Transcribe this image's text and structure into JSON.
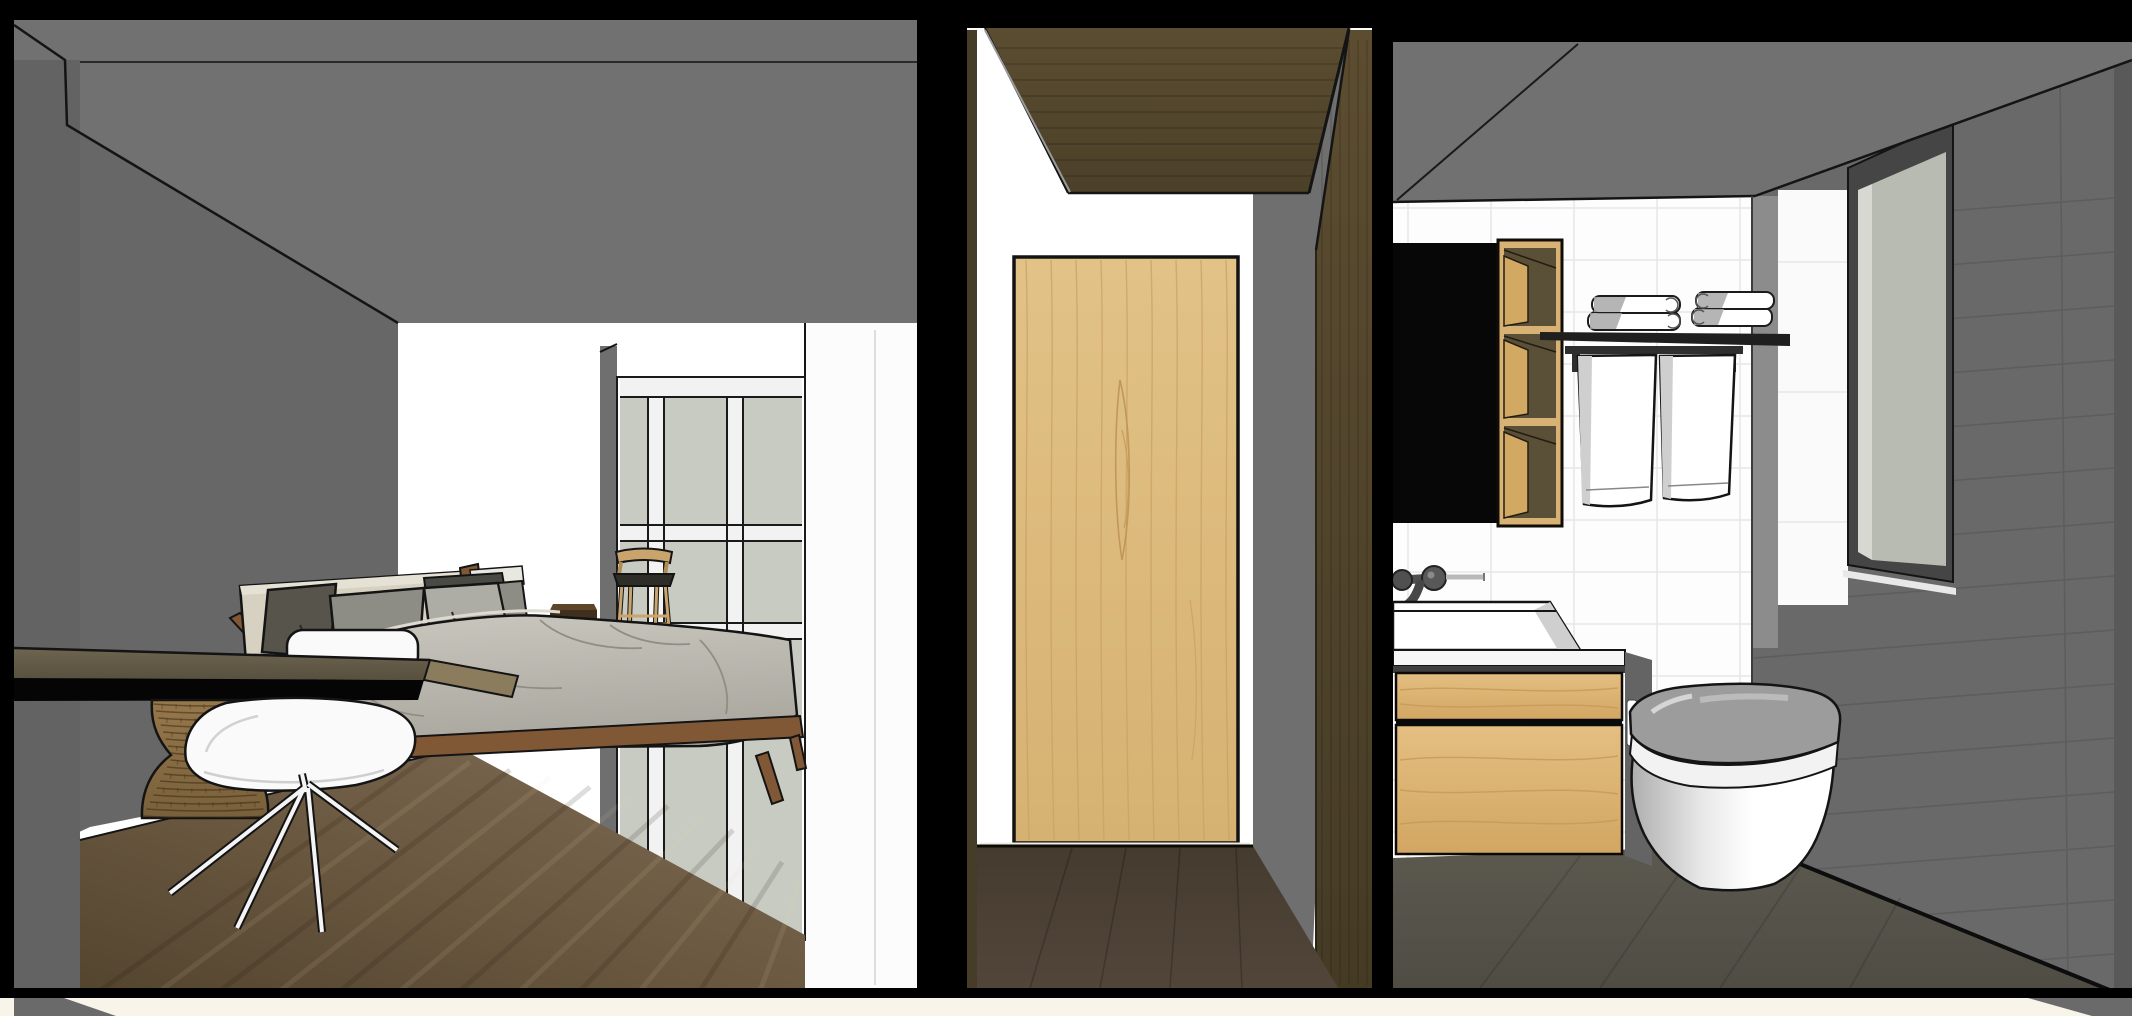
{
  "scene": {
    "title": "apartment-section-render",
    "view": "cutaway perspective section of bedroom, hallway and bathroom",
    "rooms": {
      "bedroom": {
        "label": "bedroom",
        "contents": [
          "bed",
          "pillows",
          "duvet",
          "headboard",
          "desk",
          "white-swivel-chair",
          "wicker-stool",
          "bar-stool",
          "nightstand",
          "glazed-wardrobe-wall",
          "wood-floor"
        ]
      },
      "hallway": {
        "label": "hallway",
        "contents": [
          "oak-door",
          "wood-ceiling",
          "wood-floor"
        ]
      },
      "bathroom": {
        "label": "bathroom",
        "contents": [
          "black-cabinet",
          "oak-shelf-unit",
          "towel-shelf",
          "folded-towels",
          "hanging-towels",
          "wall-faucet",
          "vessel-sink",
          "oak-vanity",
          "toilet",
          "window",
          "tiled-wall"
        ]
      }
    },
    "colors": {
      "frame": "#000000",
      "bottom_strip": "#f8f4ea",
      "ceiling_gray": "#717171",
      "wall_gray": "#6f6f6f",
      "wall_gray_dark": "#676767",
      "wall_cut_gray": "#636363",
      "white_wall": "#ffffff",
      "white_strip": "#fcfcfc",
      "glass_green": "#c8cbc2",
      "mullion": "#f2f2f2",
      "window_glass": "#b8bbb1",
      "window_frame": "#454545",
      "sash_light": "#d8d8d3",
      "hall_ceiling": "#55492e",
      "hall_column": "#54472c",
      "hall_sliver": "#473c27",
      "door_oak": "#dcbb80",
      "hall_floor": "#4b4033",
      "tile_white": "#fdfdfd",
      "tile_grout": "#e7e7e7",
      "bath_wall_gray": "#696969",
      "bath_wall_grout": "#5d5d5d",
      "edge_strip": "#595959",
      "pillar_gray": "#8c8c8c",
      "reveal_white": "#fafafa",
      "cabinet_black": "#070707",
      "oak": "#d8b175",
      "oak_interior": "#5a5037",
      "oak_panel": "#d2a963",
      "shelf_black": "#1f1f1f",
      "towel_white": "#ffffff",
      "towel_shade": "#cfcfcf",
      "faucet_dark": "#505050",
      "metal_light": "#b9b9b9",
      "sink_white": "#ffffff",
      "counter_white": "#f6f6f6",
      "counter_edge": "#3f3f3f",
      "vanity_side": "#646464",
      "toilet_lid": "#9c9c9c",
      "toilet_white": "#ffffff",
      "bed_headboard": "#d6d1c0",
      "headboard_top": "#e5e1d4",
      "pillow_dark": "#57544c",
      "pillow_mid": "#8e8d85",
      "pillow_light": "#aeada5",
      "bed_wood": "#805835",
      "desk_end": "#8c7c5e",
      "desk_shadow": "#050505",
      "chair_white": "#fafafa",
      "basket": "#8d7247",
      "stool_wood": "#c9a46c",
      "stool_seat": "#2f2d28",
      "nightstand": "#3f2f1d",
      "nightstand_top": "#5d452a",
      "bath_floor": "#57544b",
      "gray_wedge": "#6a6a6a"
    }
  }
}
